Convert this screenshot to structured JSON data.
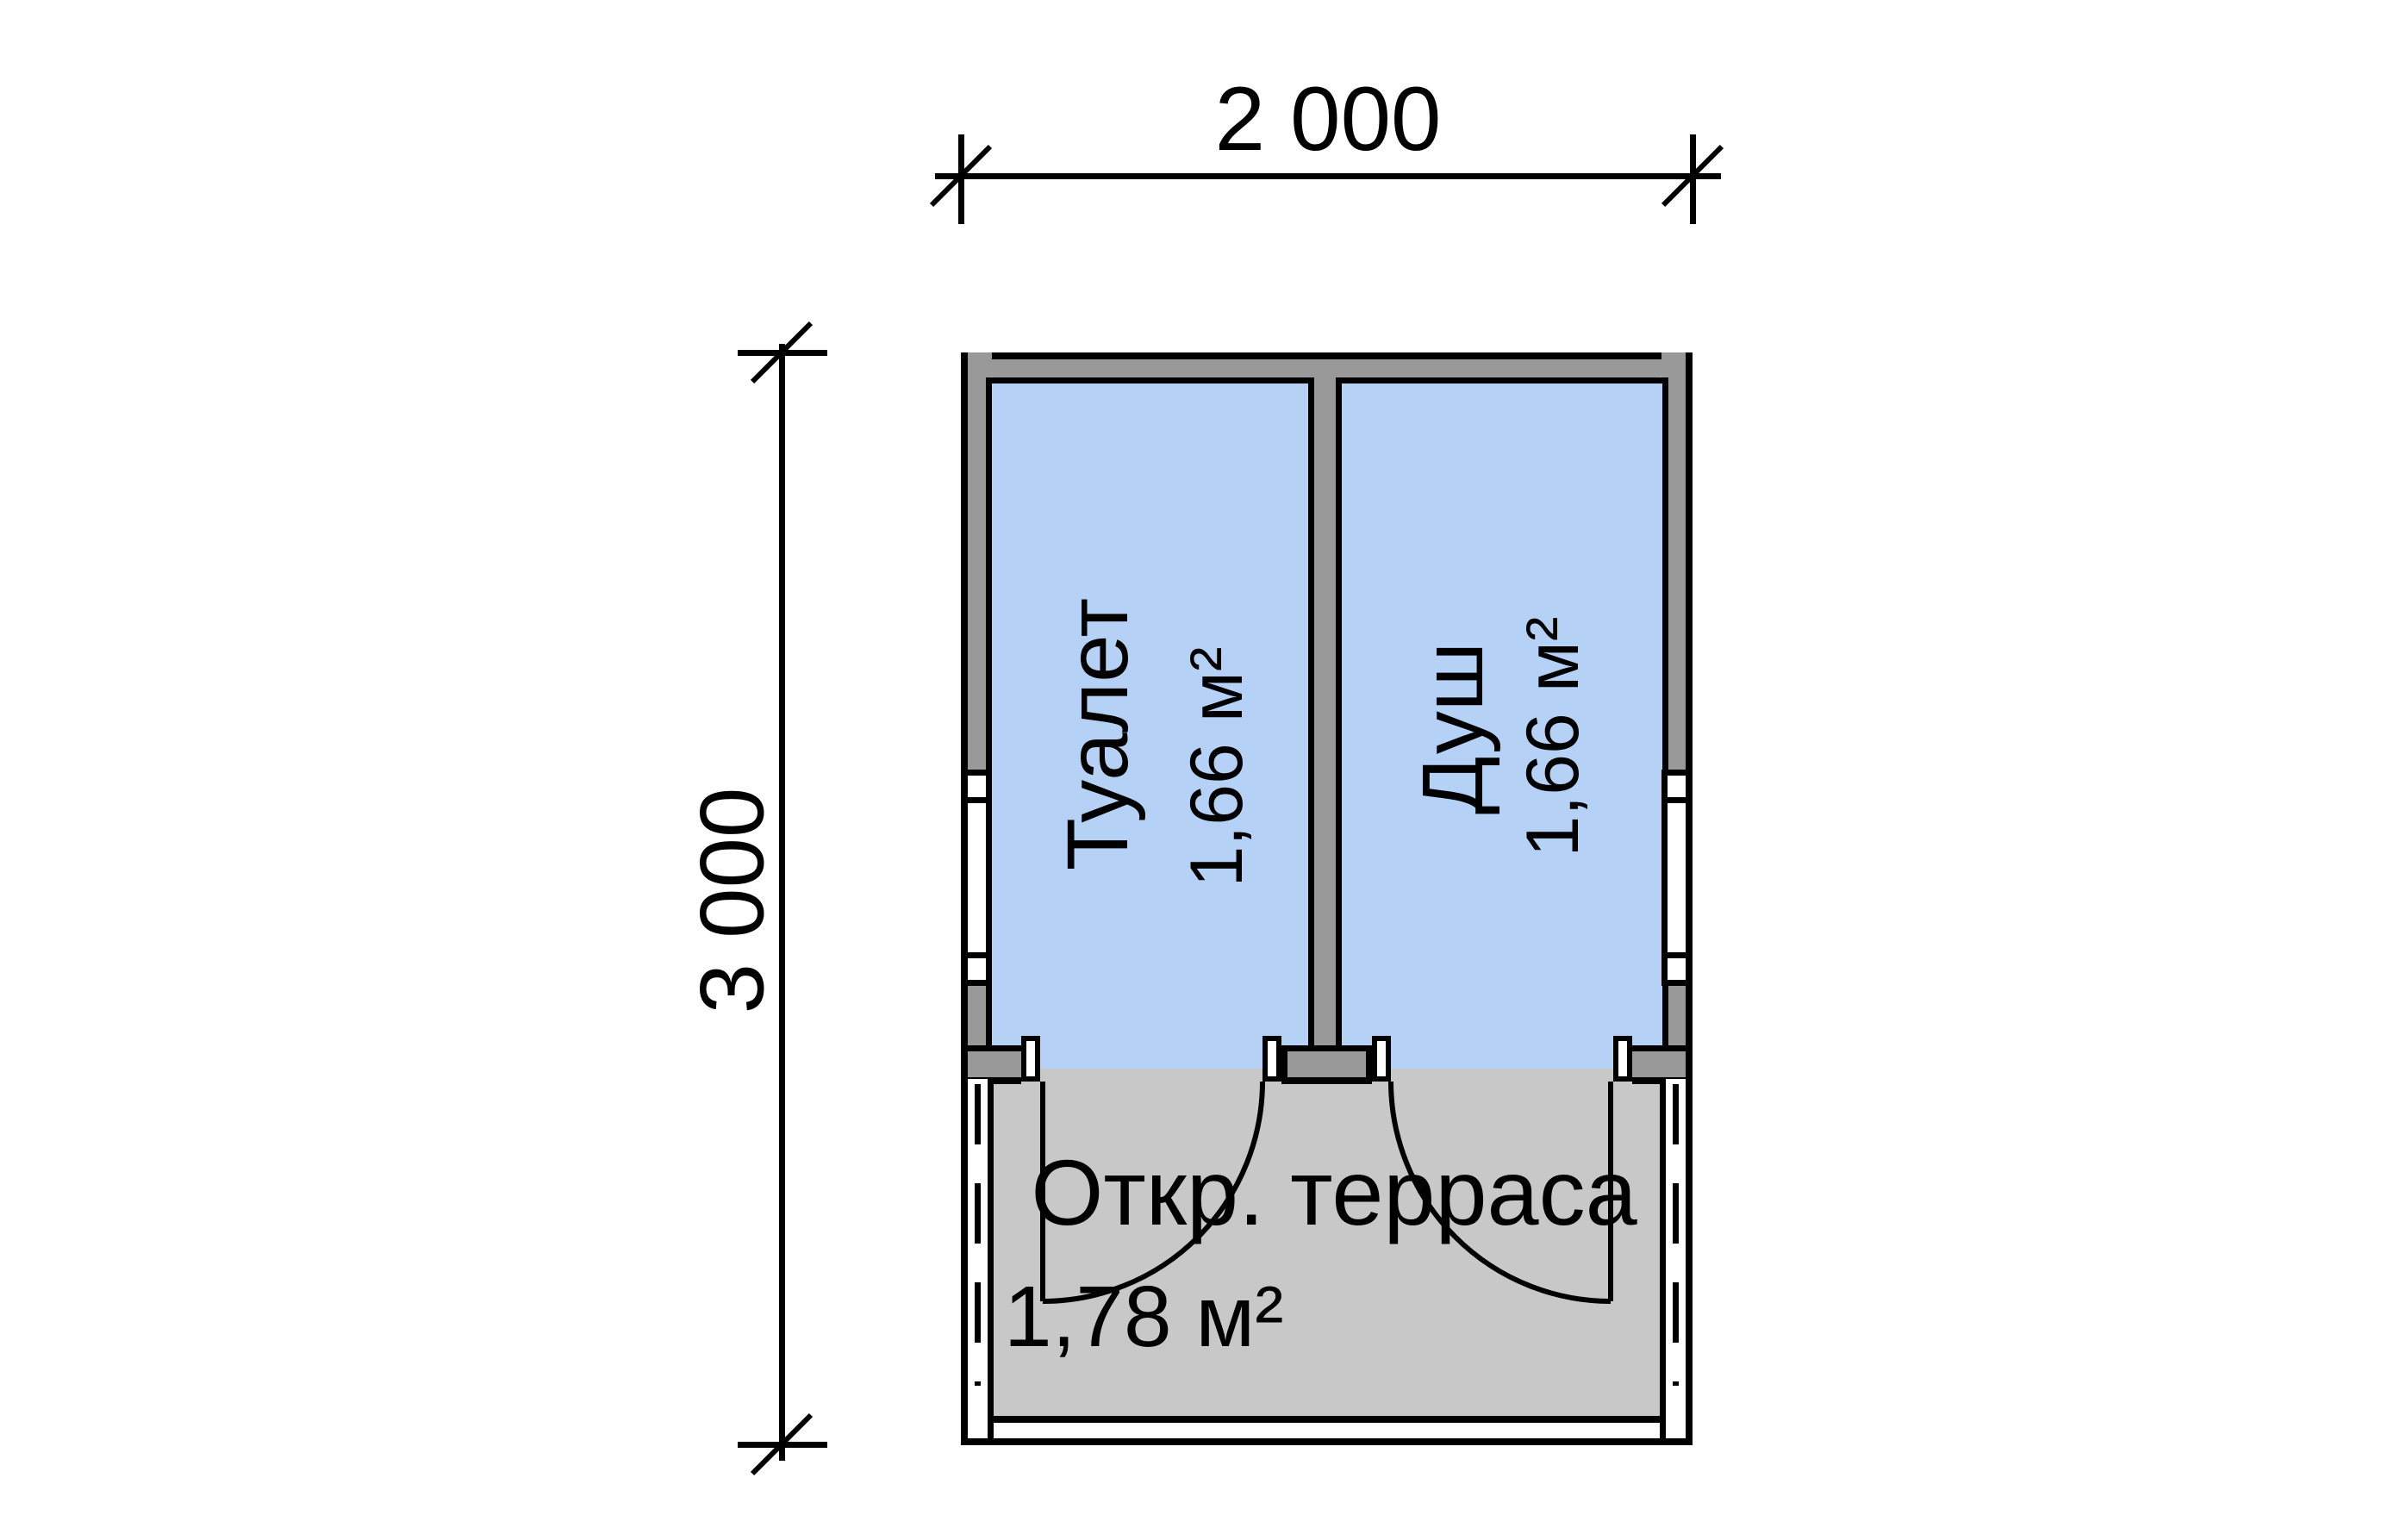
{
  "dimensions": {
    "width_label": "2 000",
    "height_label": "3 000"
  },
  "rooms": [
    {
      "name": "Туалет",
      "area": "1,66 м²"
    },
    {
      "name": "Душ",
      "area": "1,66 м²"
    }
  ],
  "terrace": {
    "name": "Откр. терраса",
    "area": "1,78 м²"
  },
  "colors": {
    "room_fill": "#b5d1f5",
    "wall_fill": "#999999",
    "terrace_fill": "#c8c8c8",
    "line": "#000000"
  }
}
